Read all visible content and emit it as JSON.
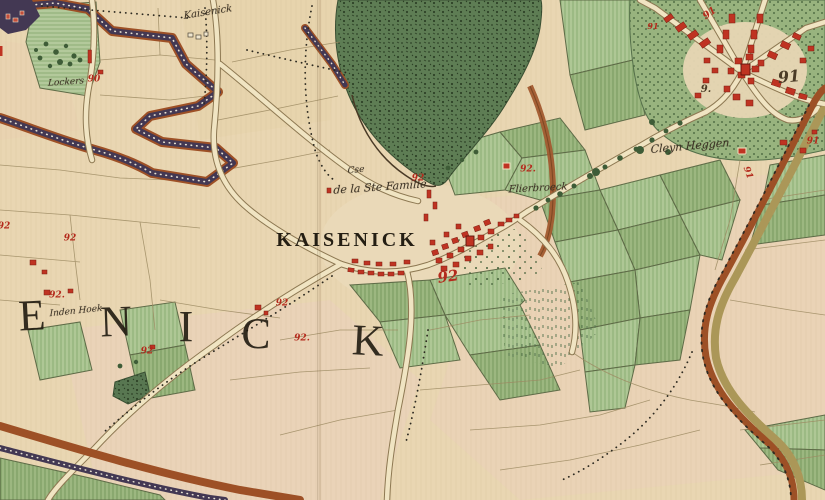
{
  "map": {
    "description": "Hand-coloured 18th-century cadastral map sheet around the village of Kaisenick",
    "region_word_visible": "ENICK",
    "labels": [
      {
        "id": "village-name-label",
        "text": "KAISENICK",
        "x": 347,
        "y": 240,
        "size": 20,
        "style": "caps",
        "rot": 0
      },
      {
        "id": "chapel-label-line1",
        "text": "Cse",
        "x": 356,
        "y": 171,
        "size": 9,
        "style": "cursive",
        "rot": -6
      },
      {
        "id": "chapel-label-line2",
        "text": "de la Ste Famille",
        "x": 380,
        "y": 187,
        "size": 11,
        "style": "cursive",
        "rot": -4
      },
      {
        "id": "hamlet-flierbroeck-label",
        "text": "Flierbroeck",
        "x": 538,
        "y": 189,
        "size": 10,
        "style": "cursive",
        "rot": -3
      },
      {
        "id": "hamlet-cleyn-heggen-label",
        "text": "Cleyn Heggen",
        "x": 690,
        "y": 146,
        "size": 11,
        "style": "cursive",
        "rot": -5
      },
      {
        "id": "hamlet-lockers-label",
        "text": "Lockers",
        "x": 66,
        "y": 83,
        "size": 9,
        "style": "cursive",
        "rot": -4
      },
      {
        "id": "hamlet-den-hoek-label",
        "text": "Inden Hoek",
        "x": 76,
        "y": 312,
        "size": 9,
        "style": "cursive",
        "rot": -6
      },
      {
        "id": "top-edge-name-label",
        "text": "Kaisenick",
        "x": 208,
        "y": 13,
        "size": 10,
        "style": "cursive",
        "rot": -9
      }
    ],
    "region_letters": [
      {
        "char": "E",
        "x": 32,
        "y": 316,
        "size": 44,
        "rot": -3
      },
      {
        "char": "N",
        "x": 116,
        "y": 322,
        "size": 44,
        "rot": -2
      },
      {
        "char": "I",
        "x": 186,
        "y": 327,
        "size": 44,
        "rot": 0
      },
      {
        "char": "C",
        "x": 256,
        "y": 334,
        "size": 44,
        "rot": 2
      },
      {
        "char": "K",
        "x": 368,
        "y": 341,
        "size": 44,
        "rot": 3
      }
    ],
    "numbers": [
      {
        "text": "90",
        "x": 94,
        "y": 80,
        "size": 9
      },
      {
        "text": "91",
        "x": 710,
        "y": 14,
        "size": 10,
        "rot": -35
      },
      {
        "text": "91",
        "x": 653,
        "y": 26,
        "size": 8
      },
      {
        "text": "91",
        "x": 789,
        "y": 77,
        "size": 16,
        "ink": "dark",
        "rot": -5
      },
      {
        "text": "9.",
        "x": 706,
        "y": 90,
        "size": 10,
        "ink": "dark"
      },
      {
        "text": "92",
        "x": 418,
        "y": 179,
        "size": 9
      },
      {
        "text": "92.",
        "x": 528,
        "y": 170,
        "size": 9
      },
      {
        "text": "92",
        "x": 448,
        "y": 277,
        "size": 15,
        "rot": -8
      },
      {
        "text": "92.",
        "x": 57,
        "y": 296,
        "size": 9
      },
      {
        "text": "92",
        "x": 282,
        "y": 304,
        "size": 9
      },
      {
        "text": "92.",
        "x": 302,
        "y": 339,
        "size": 9
      },
      {
        "text": "92",
        "x": 147,
        "y": 352,
        "size": 9
      },
      {
        "text": "92",
        "x": 70,
        "y": 239,
        "size": 9
      },
      {
        "text": "92",
        "x": 4,
        "y": 227,
        "size": 9
      },
      {
        "text": "91",
        "x": 747,
        "y": 173,
        "size": 9,
        "rot": 70
      },
      {
        "text": "91",
        "x": 813,
        "y": 142,
        "size": 9
      }
    ],
    "palette": {
      "parchment": "#e9d6b2",
      "meadow_green": "#aec795",
      "forest_green": "#5e7d54",
      "hedgerow_purple": "#433853",
      "road_rust": "#9d5026",
      "building_red": "#bf3322",
      "number_red": "#b42a1c",
      "ink": "#2b241a"
    }
  }
}
